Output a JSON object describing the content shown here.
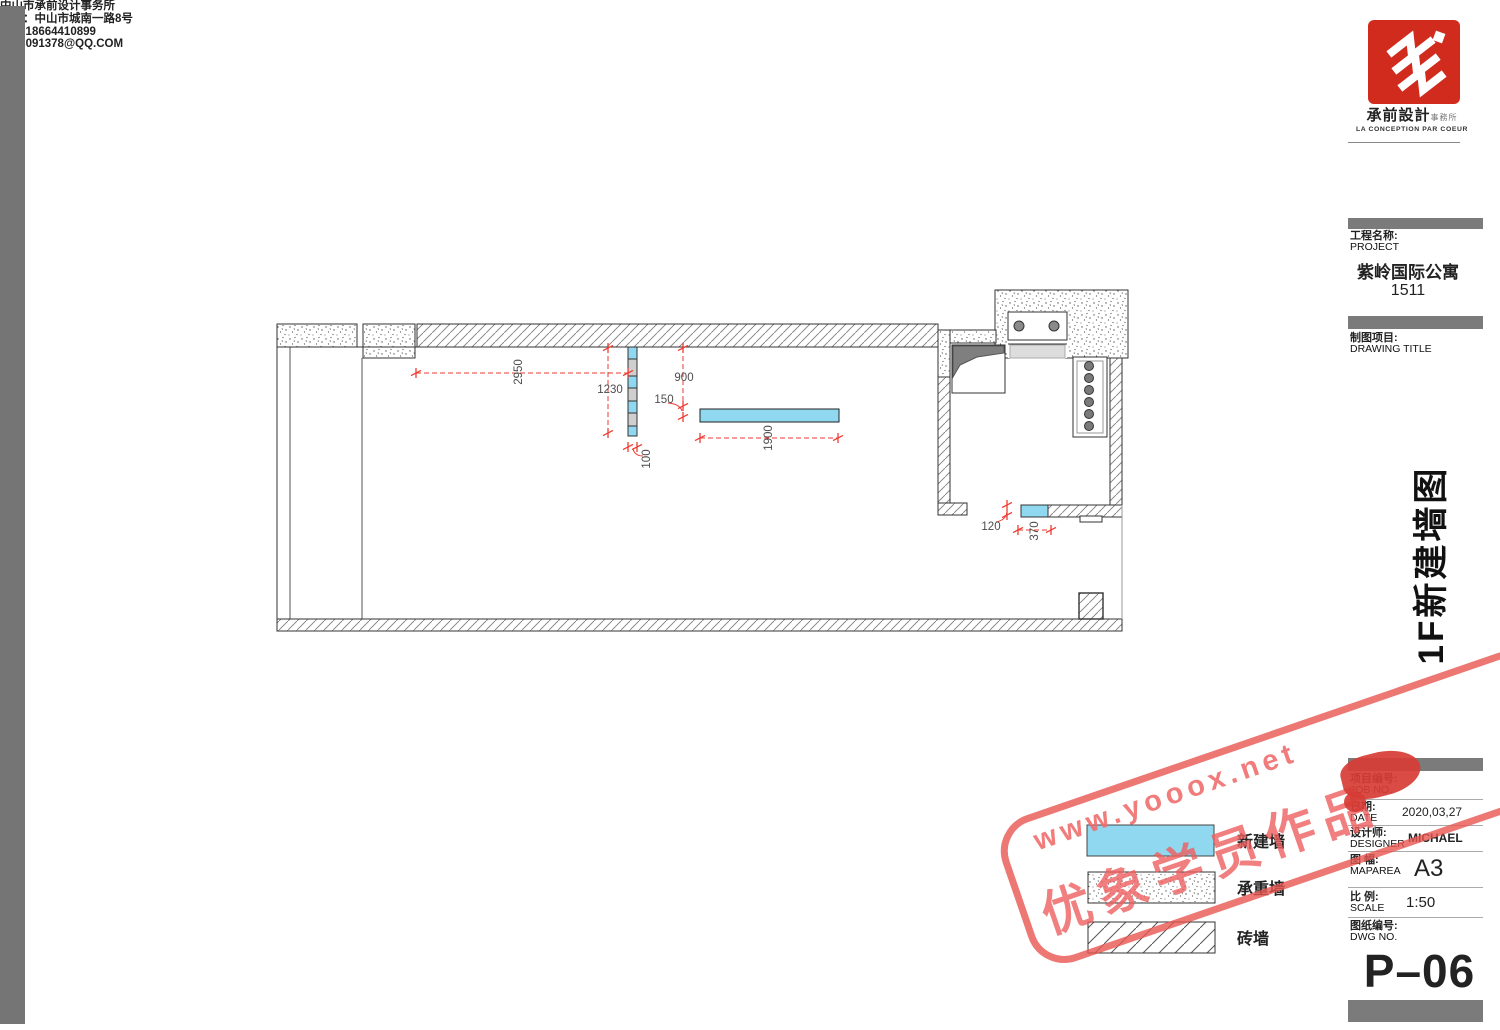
{
  "company": {
    "logo_text": "承前設計",
    "logo_suffix": "事務所",
    "logo_subtitle": "LA CONCEPTION PAR COEUR",
    "name": "中山市承前设计事务所",
    "address": "地址：中山市城南一路8号",
    "tel": "TEL:18664410899",
    "email": "1728091378@QQ.COM"
  },
  "project": {
    "label_cn": "工程名称:",
    "label_en": "PROJECT",
    "name": "紫岭国际公寓",
    "unit": "1511"
  },
  "drawing": {
    "label_cn": "制图项目:",
    "label_en": "DRAWING TITLE",
    "sheet_title": "1F新建墙图"
  },
  "titleblock": {
    "job_label_cn": "项目编号:",
    "job_label_en": "JOB NO.",
    "date_label_cn": "日期:",
    "date_label_en": "DATE",
    "date_value": "2020,03,27",
    "designer_label_cn": "设计师:",
    "designer_label_en": "DESIGNER",
    "designer_value": "MICHAEL",
    "maparea_label_cn": "图 幅:",
    "maparea_label_en": "MAPAREA",
    "maparea_value": "A3",
    "scale_label_cn": "比 例:",
    "scale_label_en": "SCALE",
    "scale_value": "1:50",
    "dwg_label_cn": "图纸编号:",
    "dwg_label_en": "DWG NO.",
    "dwg_value": "P–06"
  },
  "legend": {
    "new_wall": "新建墙",
    "load_bearing": "承重墙",
    "brick": "砖墙"
  },
  "dims": {
    "w2950": "2950",
    "w1230": "1230",
    "w900": "900",
    "w150": "150",
    "w100": "100",
    "w1900": "1900",
    "w120": "120",
    "w370": "370"
  },
  "watermark": {
    "url": "www.yooox.net",
    "label": "优象学员作品"
  },
  "colors": {
    "new_wall_fill": "#8FD8F0",
    "dimension_red": "#EE3B33",
    "logo_red": "#D02B1C",
    "bar_gray": "#757575"
  }
}
